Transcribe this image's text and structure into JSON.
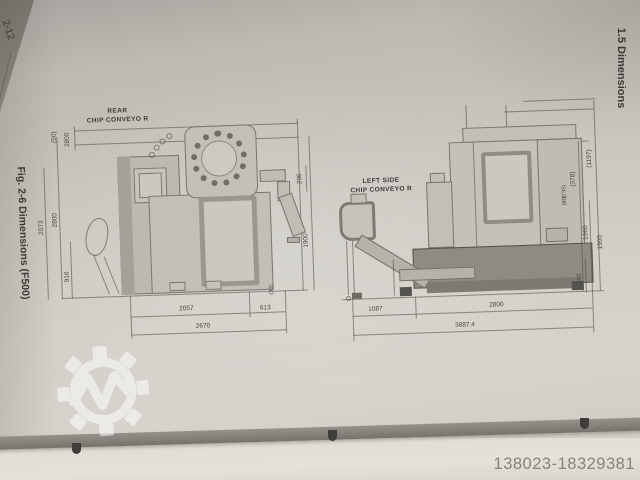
{
  "page": {
    "page_number": "2-12",
    "section_heading": "1.5 Dimensions",
    "figure_caption": "Fig. 2-6 Dimensions (F500)",
    "watermark_id": "138023-18329381"
  },
  "icons": {
    "gear_watermark": "machineseeker-gear-logo"
  },
  "colors": {
    "paper": "#cdcac3",
    "drawing_line": "#55524c",
    "page_edge": "#84817b",
    "watermark": "#ffffff"
  },
  "rear_view": {
    "title_line1": "REAR",
    "title_line2": "CHIP CONVEYO R",
    "top_dims": [
      "(50)",
      "2800"
    ],
    "left_dims": [
      "2073",
      "2800",
      "916"
    ],
    "right_dims": [
      "295",
      "1900"
    ],
    "bottom_dims": [
      "2057",
      "613",
      "2670"
    ],
    "note": "(30)"
  },
  "side_view": {
    "title_line1": "LEFT SIDE",
    "title_line2": "CHIP CONVEYO R",
    "right_dims": [
      "(1197)",
      "(378)",
      "(735)",
      "(80)",
      "1560",
      "1900",
      "340"
    ],
    "bottom_dims": [
      "1087",
      "2800",
      "3887.4"
    ]
  }
}
